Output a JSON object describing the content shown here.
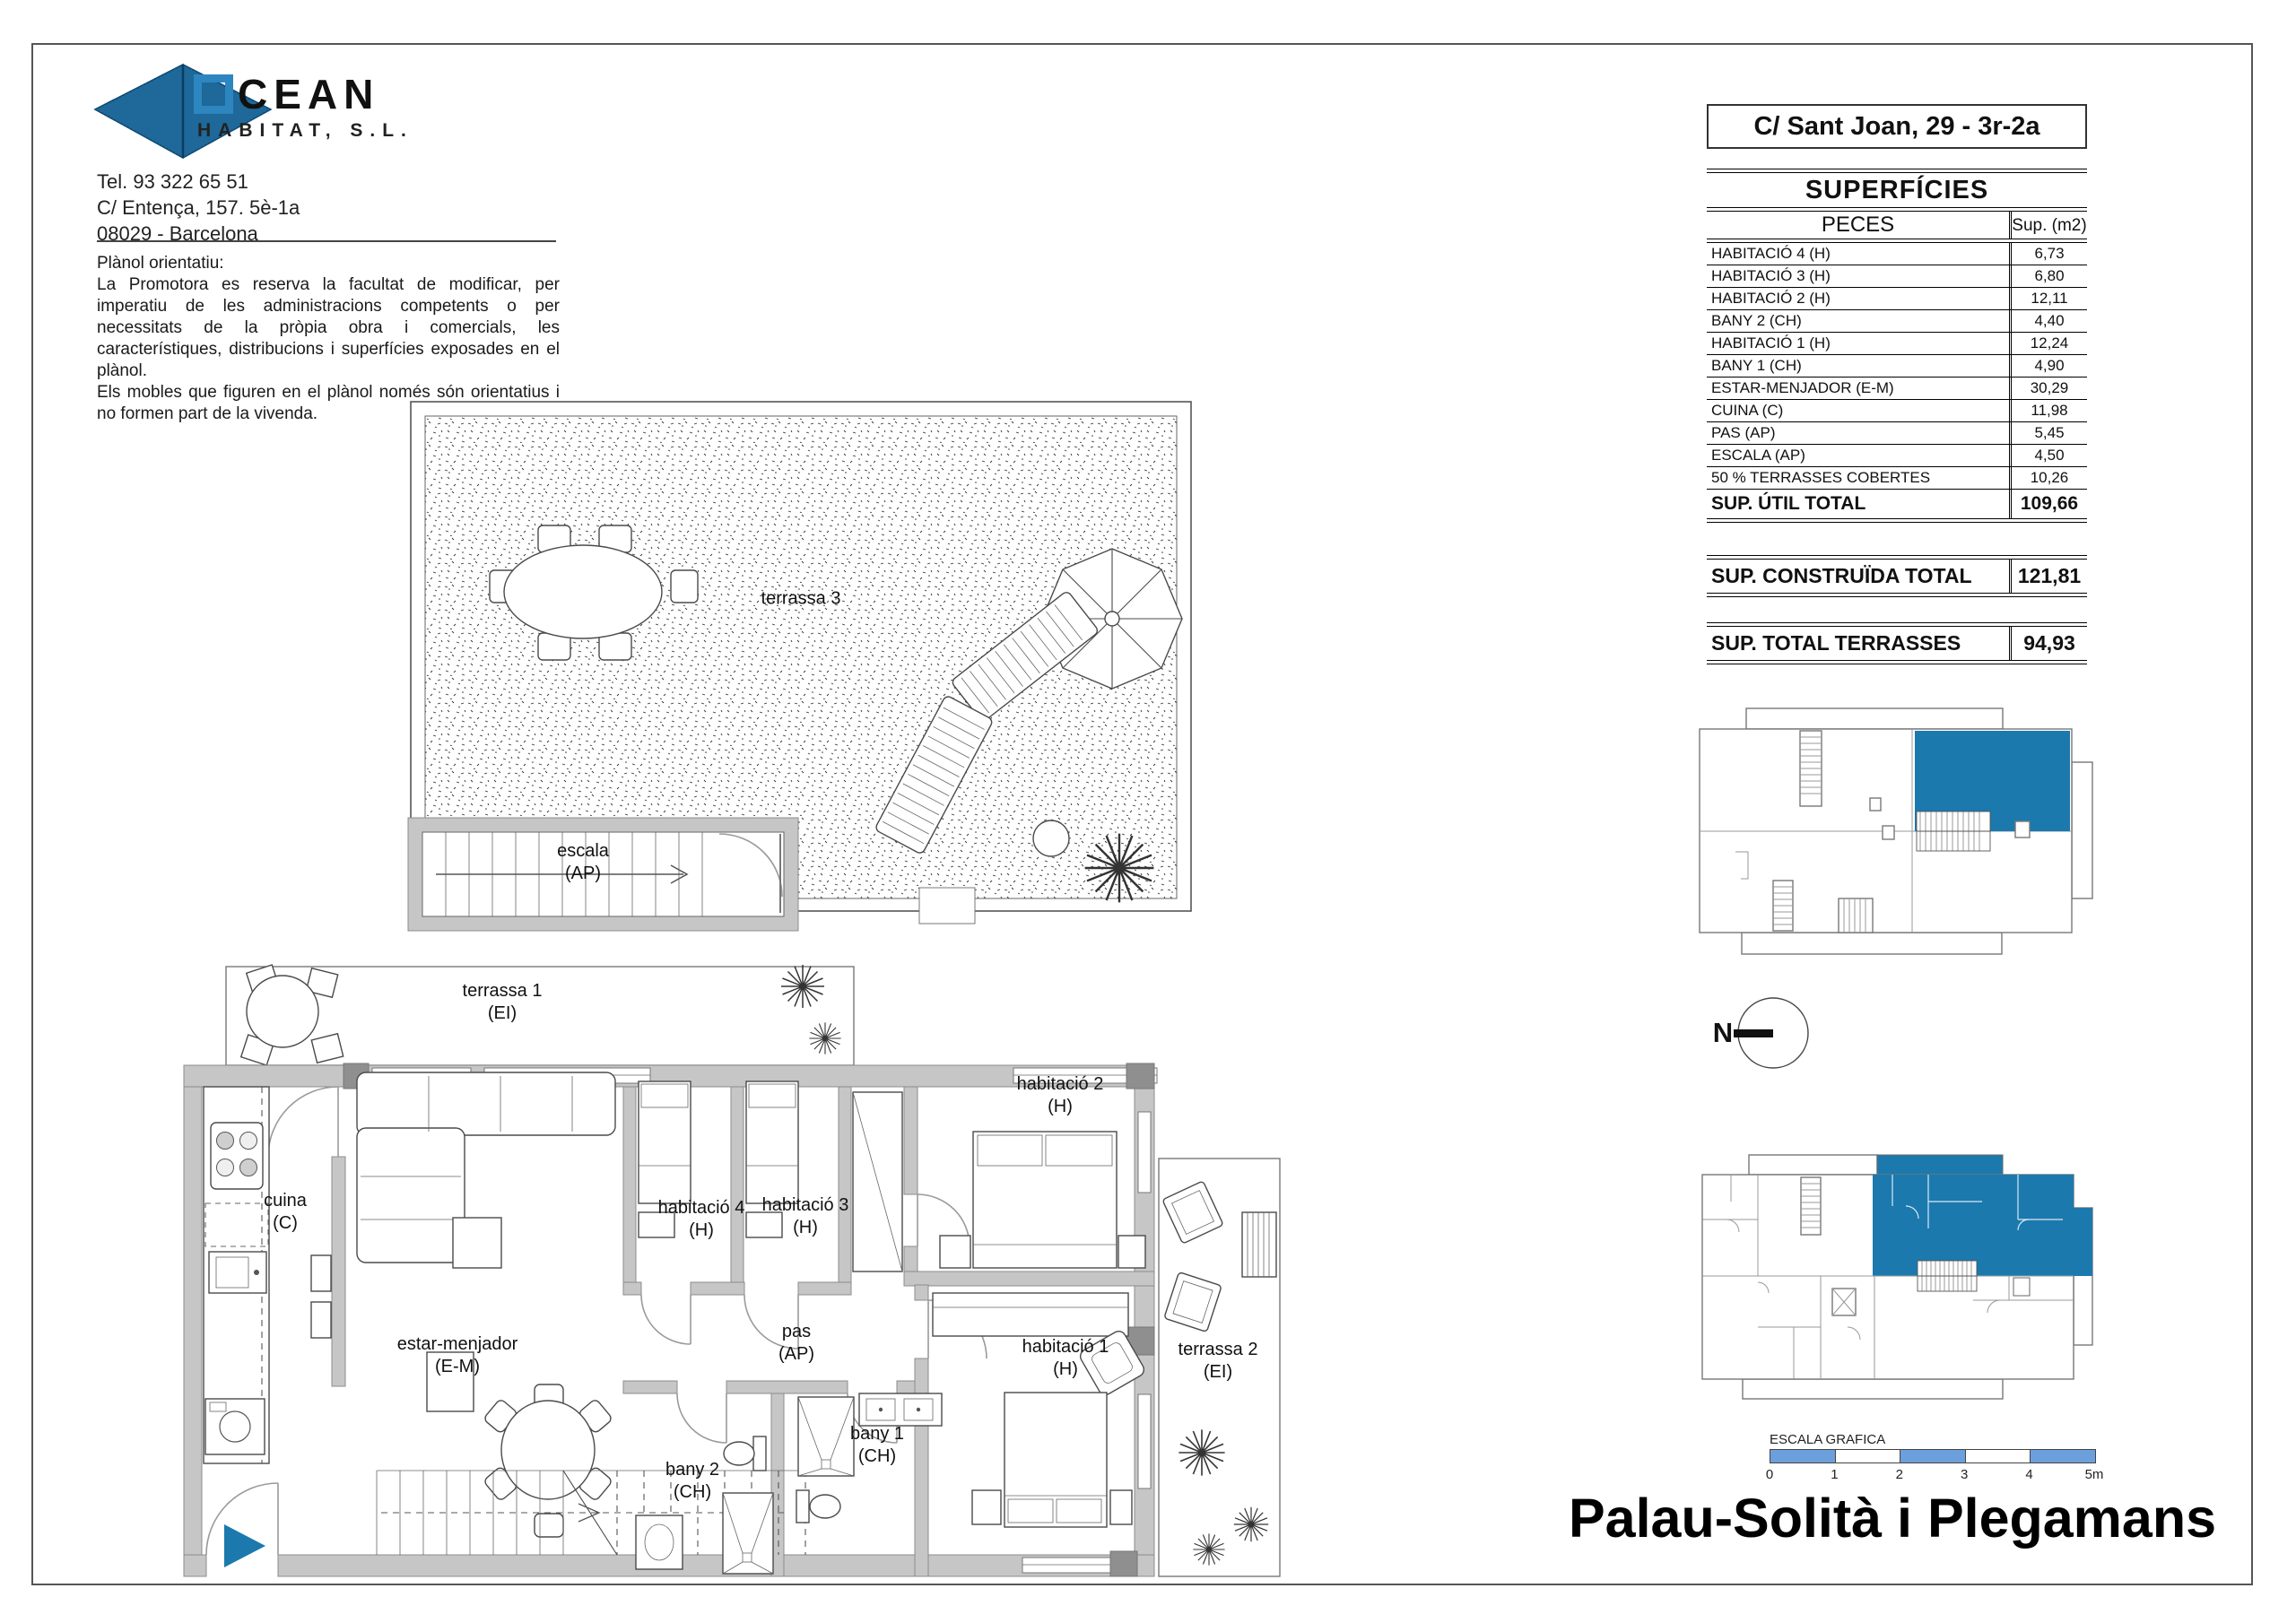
{
  "company": {
    "name": "OCEAN",
    "name_rest": "CEAN",
    "subname": "HABITAT, S.L.",
    "tel": "Tel. 93 322 65 51",
    "address1": "C/ Entença, 157. 5è-1a",
    "address2": "08029 - Barcelona"
  },
  "disclaimer": {
    "title": "Plànol orientatiu:",
    "body1": "La Promotora es reserva la facultat de modificar, per imperatiu de les administracions competents o per necessitats de la pròpia obra i comercials, les característiques, distribucions i superfícies exposades en el plànol.",
    "body2": "Els mobles que figuren en el plànol només són orientatius i no formen part de la vivenda."
  },
  "unit_title": "C/ Sant Joan, 29 - 3r-2a",
  "surfaces": {
    "title": "SUPERFÍCIES",
    "col_pieces": "PECES",
    "col_sup": "Sup. (m2)",
    "rows": [
      {
        "label": "HABITACIÓ 4 (H)",
        "value": "6,73"
      },
      {
        "label": "HABITACIÓ 3 (H)",
        "value": "6,80"
      },
      {
        "label": "HABITACIÓ 2 (H)",
        "value": "12,11"
      },
      {
        "label": "BANY 2 (CH)",
        "value": "4,40"
      },
      {
        "label": "HABITACIÓ 1 (H)",
        "value": "12,24"
      },
      {
        "label": "BANY 1 (CH)",
        "value": "4,90"
      },
      {
        "label": "ESTAR-MENJADOR (E-M)",
        "value": "30,29"
      },
      {
        "label": "CUINA (C)",
        "value": "11,98"
      },
      {
        "label": "PAS (AP)",
        "value": "5,45"
      },
      {
        "label": "ESCALA (AP)",
        "value": "4,50"
      },
      {
        "label": "50 % TERRASSES COBERTES",
        "value": "10,26"
      }
    ],
    "total_util_label": "SUP. ÚTIL TOTAL",
    "total_util_value": "109,66",
    "total_built_label": "SUP. CONSTRUÏDA TOTAL",
    "total_built_value": "121,81",
    "total_terraces_label": "SUP. TOTAL TERRASSES",
    "total_terraces_value": "94,93"
  },
  "rooms": {
    "terrassa3": {
      "name": "terrassa 3"
    },
    "escala": {
      "name": "escala",
      "code": "(AP)"
    },
    "terrassa1": {
      "name": "terrassa 1",
      "code": "(EI)"
    },
    "cuina": {
      "name": "cuina",
      "code": "(C)"
    },
    "estar": {
      "name": "estar-menjador",
      "code": "(E-M)"
    },
    "hab4": {
      "name": "habitació 4",
      "code": "(H)"
    },
    "hab3": {
      "name": "habitació 3",
      "code": "(H)"
    },
    "hab2": {
      "name": "habitació 2",
      "code": "(H)"
    },
    "hab1": {
      "name": "habitació 1",
      "code": "(H)"
    },
    "pas": {
      "name": "pas",
      "code": "(AP)"
    },
    "bany2": {
      "name": "bany 2",
      "code": "(CH)"
    },
    "bany1": {
      "name": "bany 1",
      "code": "(CH)"
    },
    "terrassa2": {
      "name": "terrassa 2",
      "code": "(EI)"
    }
  },
  "north_label": "N",
  "scale_bar": {
    "label": "ESCALA GRAFICA",
    "ticks": [
      "0",
      "1",
      "2",
      "3",
      "4",
      "5m"
    ]
  },
  "project_title": "Palau-Solità i Plegamans",
  "colors": {
    "accent_blue": "#1b79ae",
    "scale_blue": "#6ca0dc",
    "logo_blue": "#2e86c0",
    "wall_gray": "#c6c6c6"
  }
}
